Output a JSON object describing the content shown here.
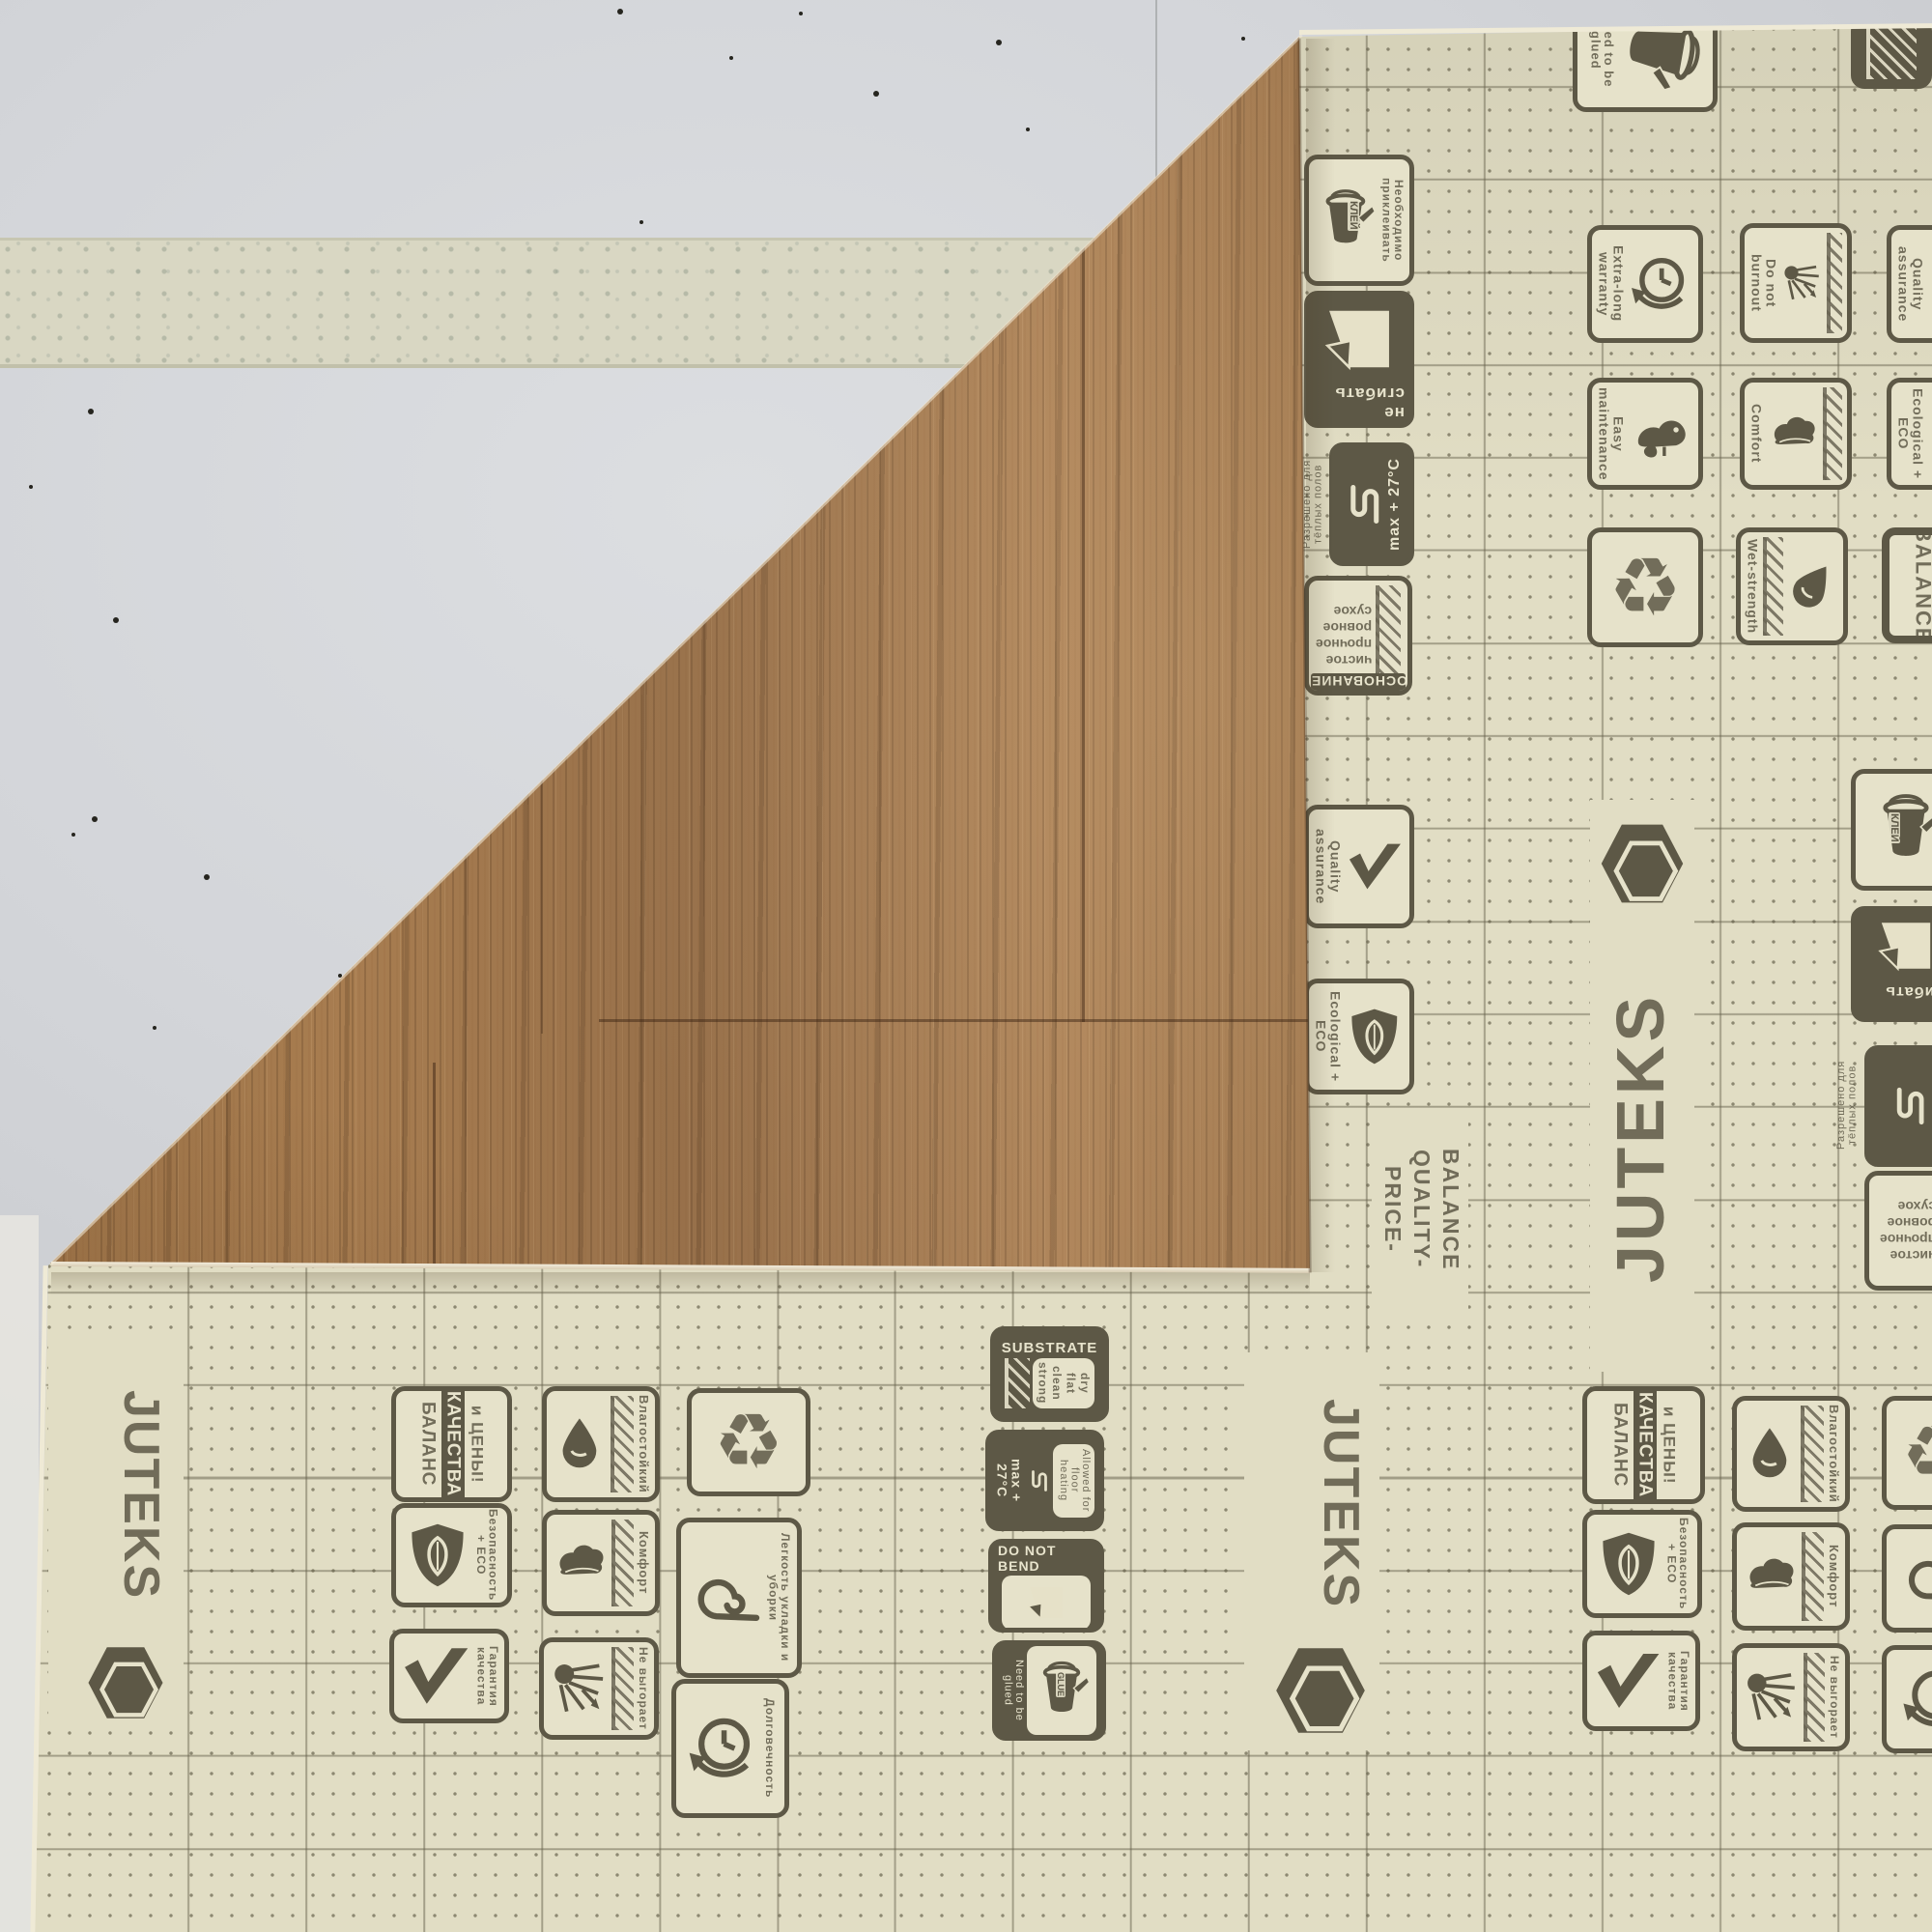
{
  "scene": {
    "subject": "JUTEKS linoleum sheet lying face-down on a grey floor, corner folded over showing oak wood-grain face; printed cream backing with icon stamps and dotted grid; strip of masking tape on the floor",
    "colors": {
      "floor": "#d6d8db",
      "tape": "#d9d7c3",
      "backing": "#e1ddc4",
      "print_ink": "#5d5846",
      "wood": "#a87d50"
    }
  },
  "brand": {
    "wordmark": "JUTEKS"
  },
  "icons": {
    "recycle": "♻"
  },
  "labels": {
    "klej": "КЛЕЙ",
    "need_glue_ru": "Необходимо приклеивать",
    "no_bend": "не сгибать",
    "max27": "max + 27°C",
    "warm_floor_ru": "Разрешено для тёплых полов",
    "substrate_ru": "ОСНОВАНИЕ",
    "dry_ru": "сухое",
    "flat_ru": "ровное",
    "strong_ru": "прочное",
    "clean_ru": "чистое",
    "quality": "Quality assurance",
    "eco": "Ecological + ECO",
    "price1": "PRICE-",
    "price2": "QUALITY-",
    "price3": "BALANCE",
    "warranty": "Extra-long warranty",
    "burnout": "Do not burnout",
    "easym": "Easy maintenance",
    "comfort_en": "Comfort",
    "wet": "Wet-strength",
    "balance_en": "BALANCE",
    "substrate_en": "SUBSTRATE",
    "dry": "dry",
    "flat": "flat",
    "clean": "clean",
    "strong": "strong",
    "heat_en": "Allowed for floor heating",
    "dnb": "DO NOT BEND",
    "glue": "GLUE",
    "need_glue": "Need to be glued",
    "bal_ru1": "БАЛАНС",
    "bal_ru2": "КАЧЕСТВА",
    "bal_ru3": "и ЦЕНЫ!",
    "moist": "Влагостойкий",
    "safe": "Безопасность + ECO",
    "comfort_ru": "Комфорт",
    "guar": "Гарантия качества",
    "fade": "Не выгорает",
    "ease": "Легкость укладки и уборки",
    "dur": "Долговечность"
  }
}
